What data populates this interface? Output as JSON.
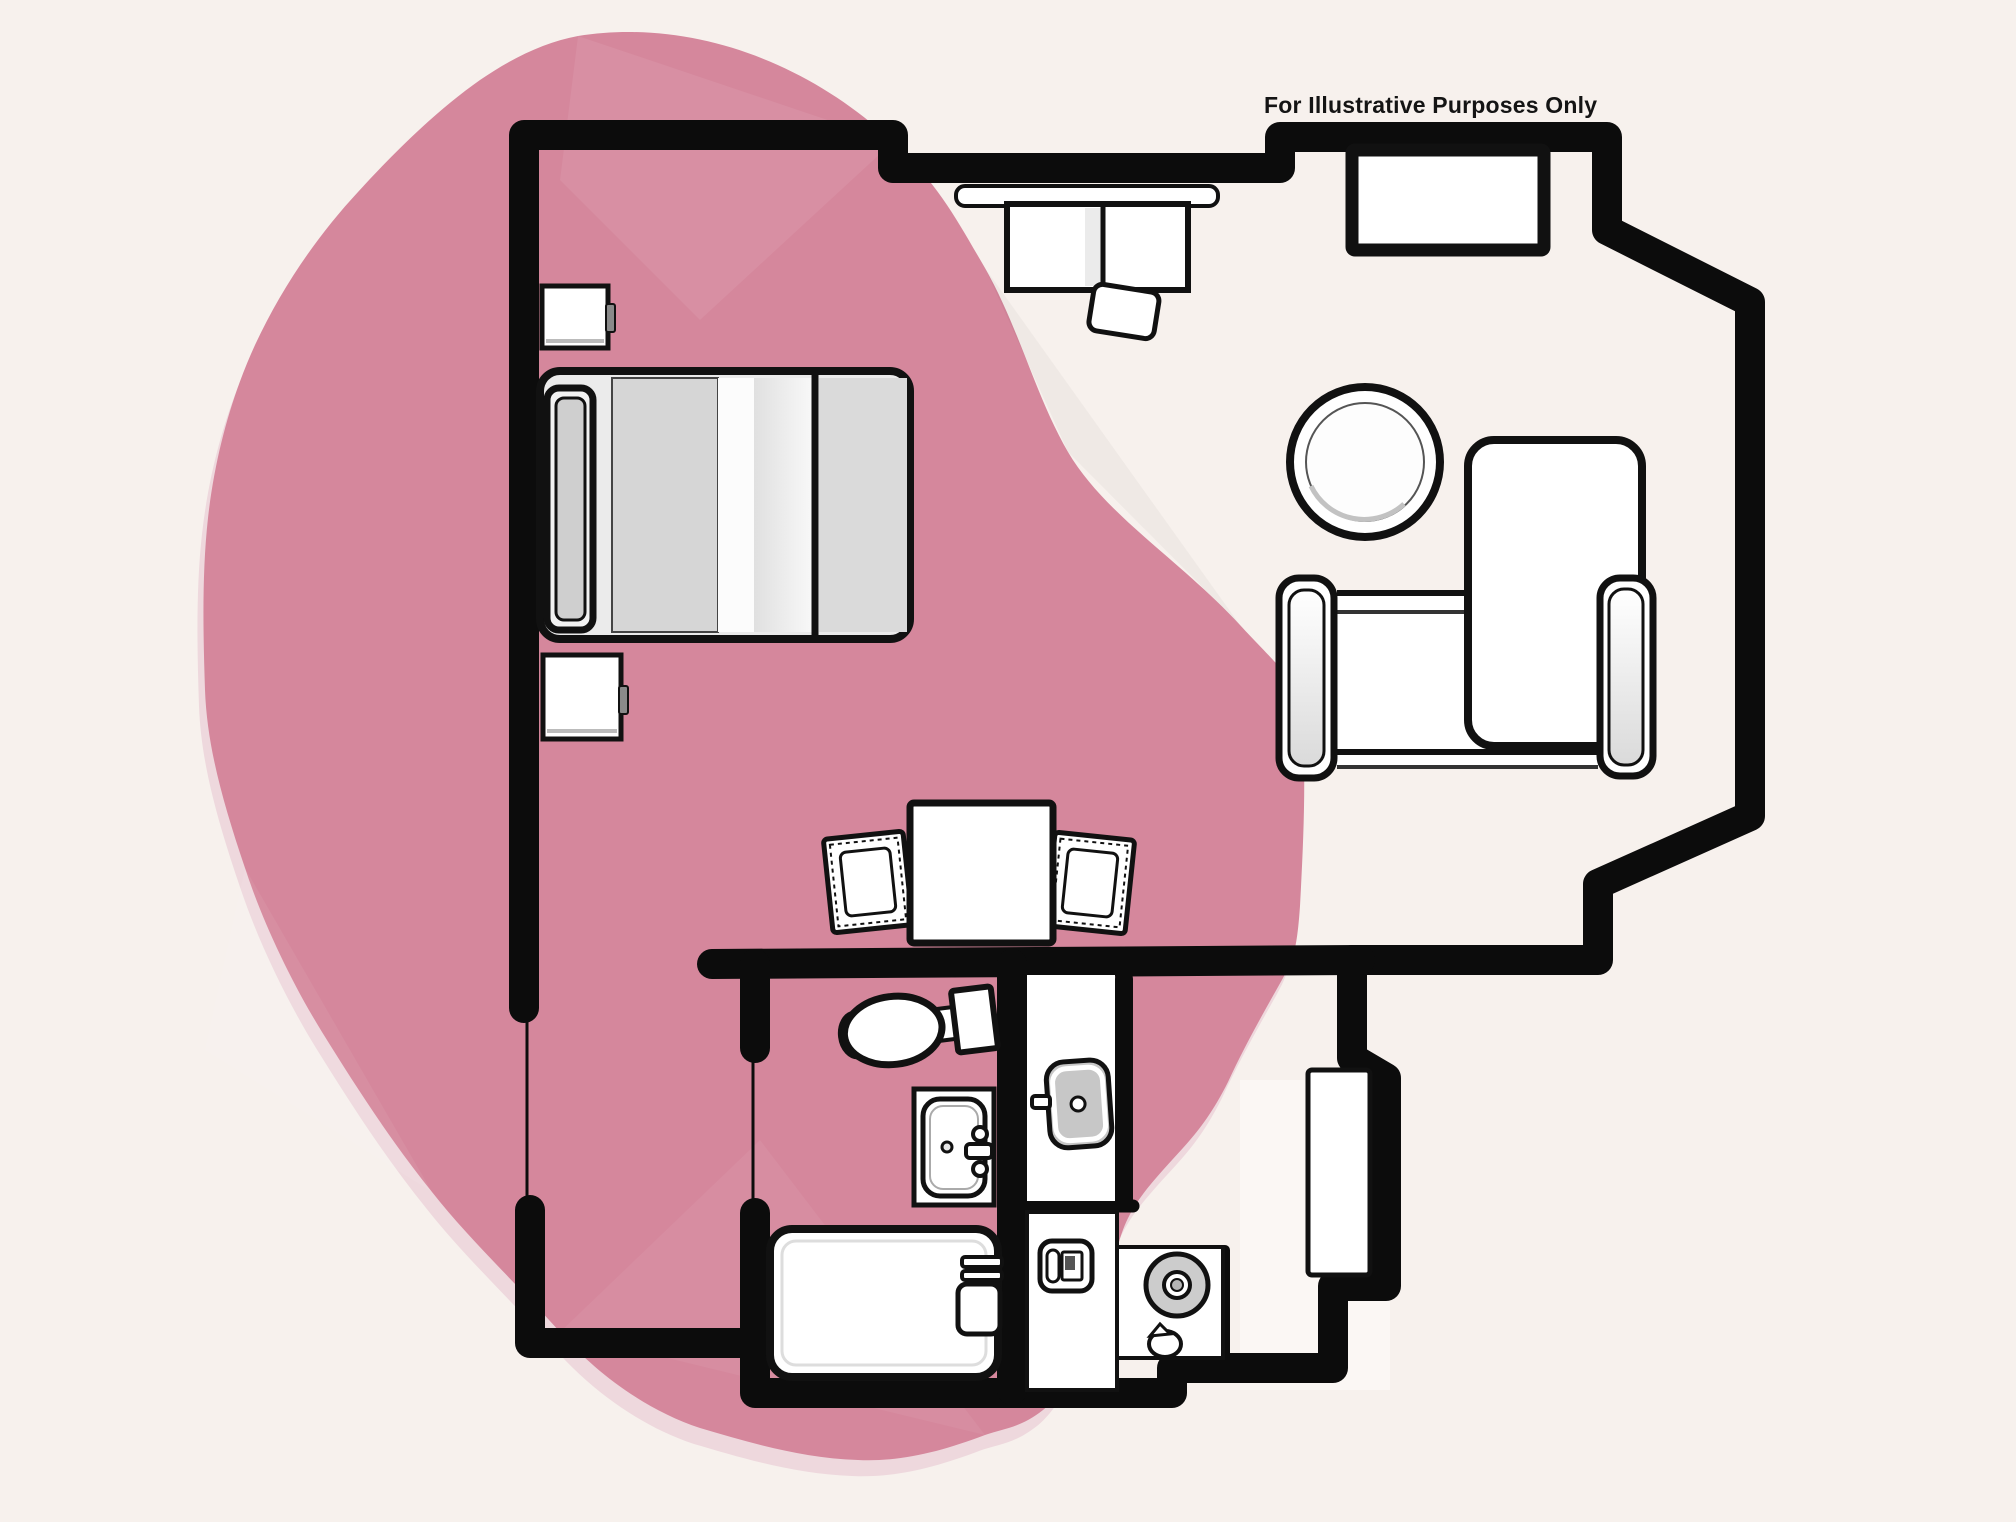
{
  "annotation": {
    "text": "For Illustrative Purposes Only"
  },
  "colors": {
    "background": "#f7f1ed",
    "accent_blob": "#d5879c",
    "blob_halo": "#eed8dd",
    "wall": "#0c0c0c",
    "furniture_fill": "#ffffff",
    "mattress_gray": "#d6d6d6",
    "basin_gray": "#c7c7c7",
    "entry_floor": "#fbf7f4"
  },
  "floorplan": {
    "type": "hotel-suite-floor-plan",
    "items": [
      "double-bed",
      "headboard-pillow",
      "nightstand-upper",
      "nightstand-lower",
      "wall-desk",
      "desk-chair",
      "tv-console",
      "round-side-table",
      "lounge-chair",
      "chaise-cushion",
      "dining-table",
      "dining-chair-left",
      "dining-chair-right",
      "toilet",
      "bathtub",
      "shower",
      "vanity-sink",
      "kitchen-counter",
      "coffee-maker",
      "cooktop-burner",
      "kitchen-faucet",
      "entry-door"
    ]
  }
}
